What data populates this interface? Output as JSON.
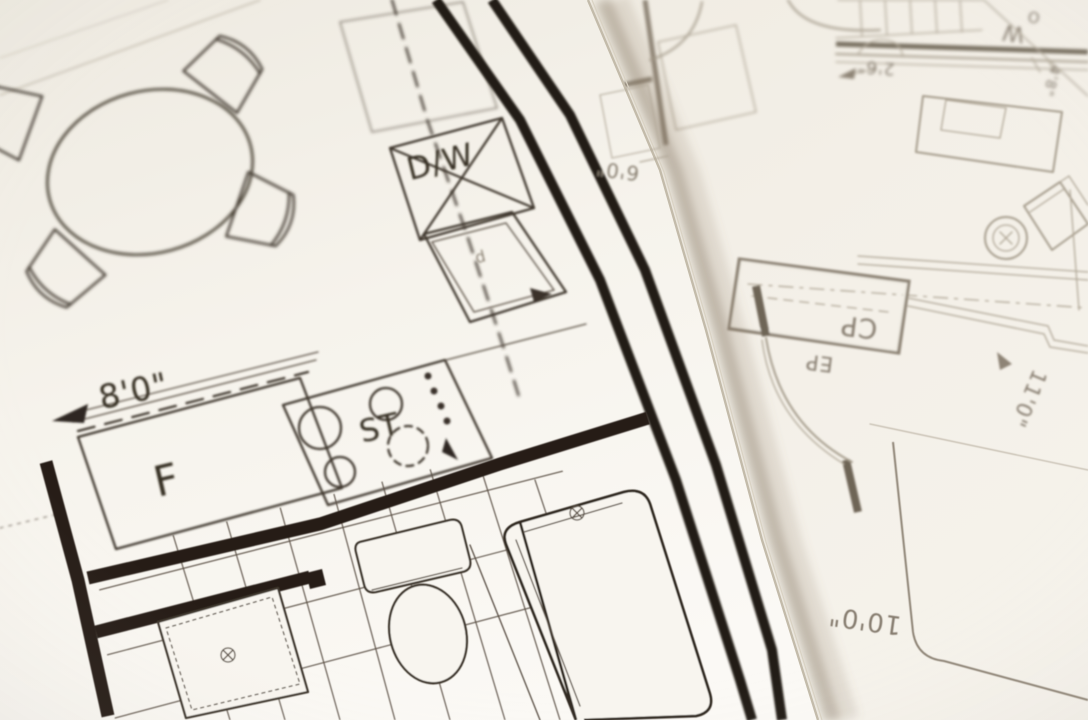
{
  "colors": {
    "top_sheet_paper": "#f8f5ef",
    "under_sheet_paper": "#f1ede4",
    "top_sheet_ink": "#2b241c",
    "under_sheet_ink": "#a59c8c",
    "edge_shadow": "#837660"
  },
  "sheet_top": {
    "labels": {
      "dishwasher": "D/W",
      "stove": "ST",
      "fridge": "F",
      "cabinet_glyph": "d",
      "dim_kitchen_width": "8'0\"",
      "dim_edge_strip": "6'0\""
    }
  },
  "sheet_under": {
    "labels": {
      "closet": "CP",
      "panel": "EP",
      "room_w": "W",
      "room_o": "O",
      "dim_a": "2'6\"",
      "dim_b": "4'8\"",
      "dim_c": "11'0\"",
      "dim_d": "10'0\""
    }
  }
}
